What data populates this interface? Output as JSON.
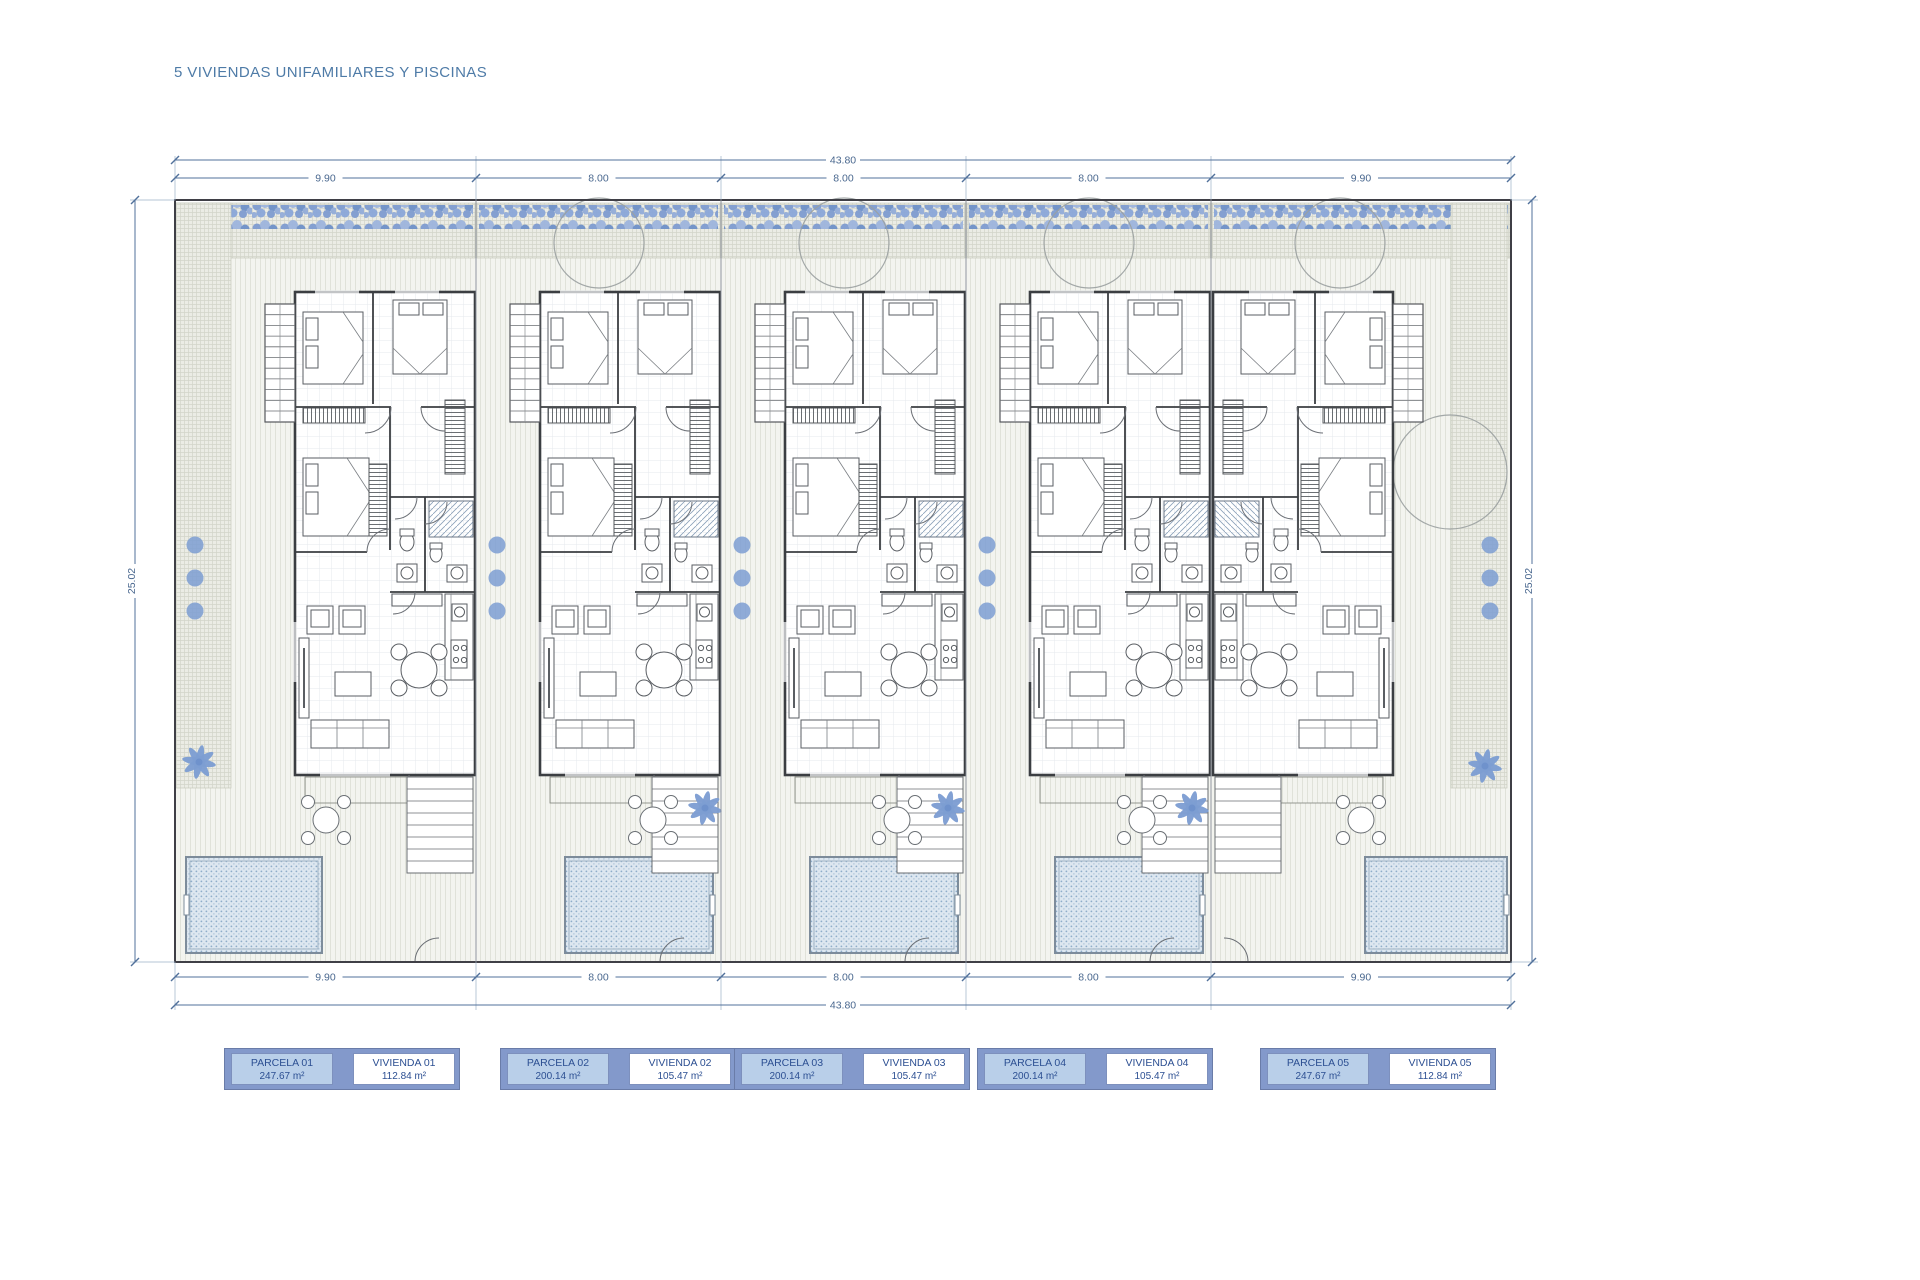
{
  "title": "5 VIVIENDAS UNIFAMILIARES Y PISCINAS",
  "dimensions": {
    "total_top": "43.80",
    "total_bottom": "43.80",
    "side_left": "25.02",
    "side_right": "25.02",
    "segments_top": [
      "9.90",
      "8.00",
      "8.00",
      "8.00",
      "9.90"
    ],
    "segments_bottom": [
      "9.90",
      "8.00",
      "8.00",
      "8.00",
      "9.90"
    ]
  },
  "legend": [
    {
      "parcela_label": "PARCELA 01",
      "parcela_area": "247.67 m²",
      "vivienda_label": "VIVIENDA 01",
      "vivienda_area": "112.84 m²"
    },
    {
      "parcela_label": "PARCELA 02",
      "parcela_area": "200.14 m²",
      "vivienda_label": "VIVIENDA 02",
      "vivienda_area": "105.47 m²"
    },
    {
      "parcela_label": "PARCELA 03",
      "parcela_area": "200.14 m²",
      "vivienda_label": "VIVIENDA 03",
      "vivienda_area": "105.47 m²"
    },
    {
      "parcela_label": "PARCELA 04",
      "parcela_area": "200.14 m²",
      "vivienda_label": "VIVIENDA 04",
      "vivienda_area": "105.47 m²"
    },
    {
      "parcela_label": "PARCELA 05",
      "parcela_area": "247.67 m²",
      "vivienda_label": "VIVIENDA 05",
      "vivienda_area": "112.84 m²"
    }
  ],
  "colors": {
    "title_text": "#4e7ba7",
    "dim_line": "#51719b",
    "dim_text": "#4a688f",
    "accent_blue": "#7d9ed2",
    "wall": "#3b3e42",
    "legend_frame": "#8399cb",
    "legend_parcela_bg": "#b9cfe9",
    "legend_text": "#2c4f92",
    "pool_border": "#7d8c9b"
  }
}
